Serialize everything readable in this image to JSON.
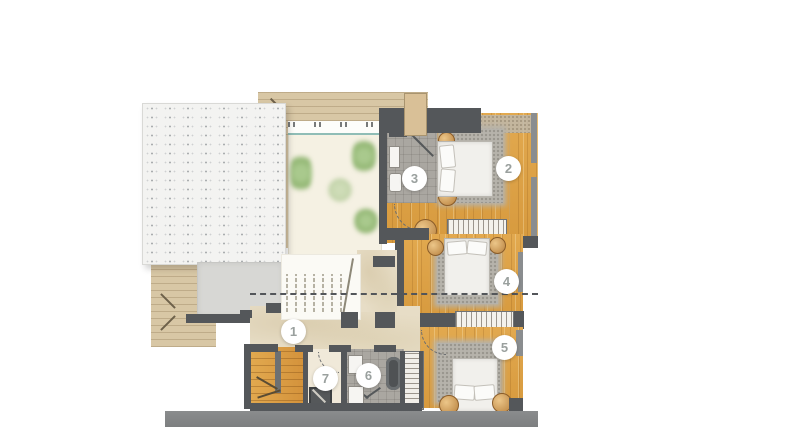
{
  "floorplan": {
    "markers": [
      {
        "label": "1"
      },
      {
        "label": "2"
      },
      {
        "label": "3"
      },
      {
        "label": "4"
      },
      {
        "label": "5"
      },
      {
        "label": "6"
      },
      {
        "label": "7"
      }
    ],
    "colors": {
      "wall": "#54575a",
      "wood": "#e2a94f",
      "deck": "#d8c7a5",
      "terrace": "#f5f1e3",
      "hall": "#e7ddc6",
      "tile": "#aaa7a1",
      "rug": "#b6b3ab",
      "plant": "#8fb470",
      "pergola": "#f3f3f1",
      "ground": "#7d7f80",
      "marker_text": "#9aa09e"
    }
  }
}
